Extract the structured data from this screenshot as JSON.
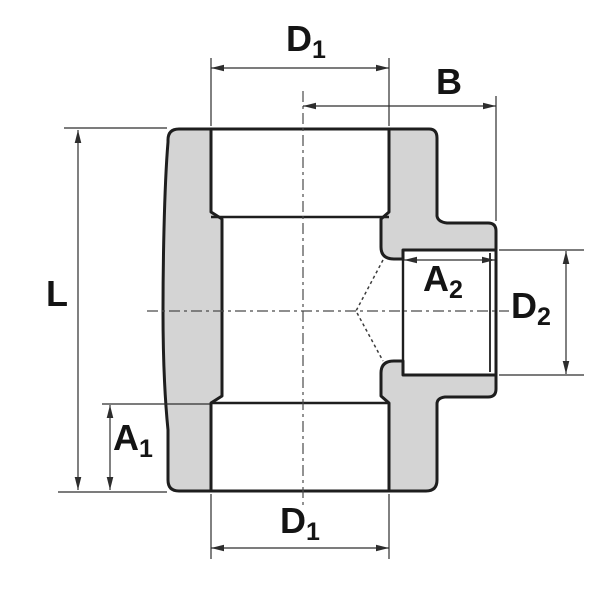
{
  "labels": {
    "d1_top": {
      "main": "D",
      "sub": "1"
    },
    "b": {
      "main": "B",
      "sub": ""
    },
    "l": {
      "main": "L",
      "sub": ""
    },
    "a2": {
      "main": "A",
      "sub": "2"
    },
    "d2": {
      "main": "D",
      "sub": "2"
    },
    "a1": {
      "main": "A",
      "sub": "1"
    },
    "d1_bottom": {
      "main": "D",
      "sub": "1"
    }
  },
  "colors": {
    "part_fill": "#d4d4d4",
    "outline": "#1e1e1e",
    "dim": "#2d2d2d",
    "center": "#4a4a4a",
    "bg": "#ffffff",
    "text": "#141414"
  }
}
